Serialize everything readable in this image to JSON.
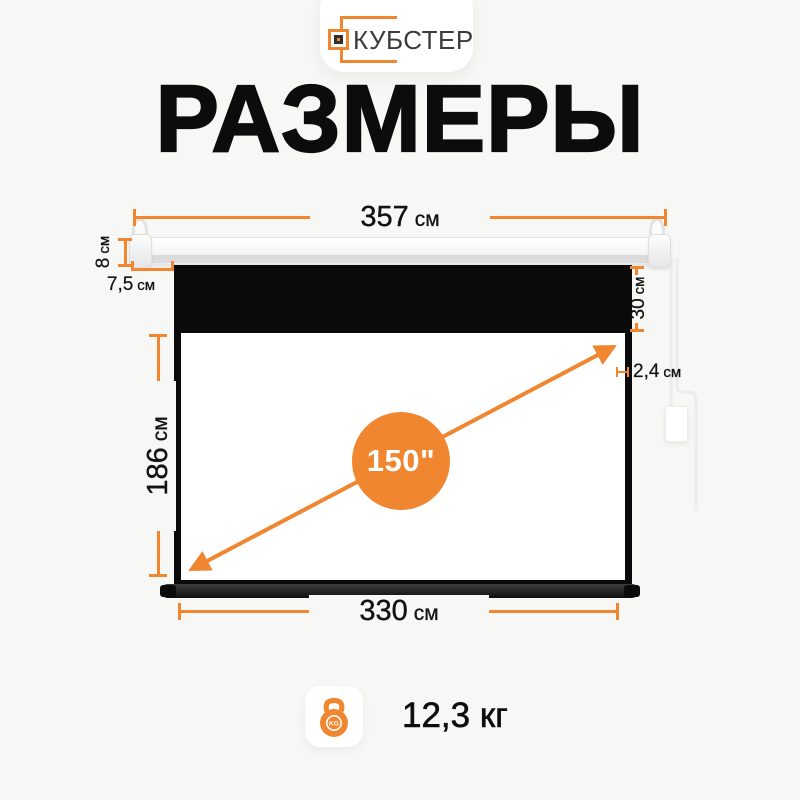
{
  "brand": {
    "name": "КУБСТЕР"
  },
  "title": "РАЗМЕРЫ",
  "dimensions": {
    "total_width": {
      "value": "357",
      "unit": "см"
    },
    "case_height": {
      "value": "8",
      "unit": "см"
    },
    "edge_offset": {
      "value": "7,5",
      "unit": "см"
    },
    "top_drop": {
      "value": "30",
      "unit": "см"
    },
    "view_height": {
      "value": "186",
      "unit": "см"
    },
    "border_width": {
      "value": "2,4",
      "unit": "см"
    },
    "view_width": {
      "value": "330",
      "unit": "см"
    },
    "diagonal": {
      "value": "150\""
    }
  },
  "weight": {
    "value": "12,3 кг",
    "kg_badge": "KG"
  },
  "colors": {
    "accent": "#F0862F",
    "screen_frame": "#0A0A0A",
    "background": "#F7F7F5"
  }
}
